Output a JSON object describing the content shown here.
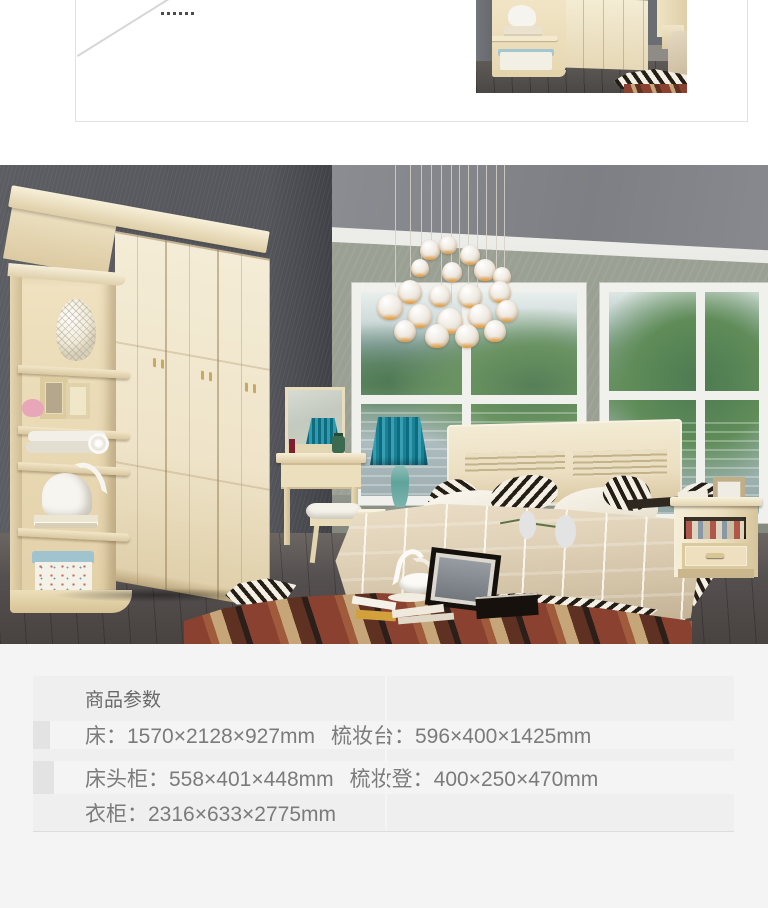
{
  "top_box": {
    "ellipsis": "......"
  },
  "spec_table": {
    "title": "商品参数",
    "rows": [
      {
        "left": "床：1570×2128×927mm",
        "right": "梳妆台：596×400×1425mm"
      },
      {
        "left": "床头柜：558×401×448mm",
        "right": "梳妆登：400×250×470mm"
      },
      {
        "left": "衣柜：2316×633×2775mm",
        "right": ""
      }
    ]
  },
  "colors": {
    "section_bg": "#f5f4f5",
    "row_dark": "#e3e3e3",
    "row_light": "#efefef",
    "table_text": "#7b7b7b",
    "panel_border": "#e2e2e2",
    "wardrobe_cream": "#efe4c9",
    "wall_dark": "#56585e",
    "wall_back": "#9aa093",
    "ceiling_gray": "#84868b",
    "lamp_teal": "#2f9cae",
    "bedding_champagne": "#d5c8b2",
    "carpet_red": "#8a4130",
    "floor_brown": "#514c49"
  }
}
